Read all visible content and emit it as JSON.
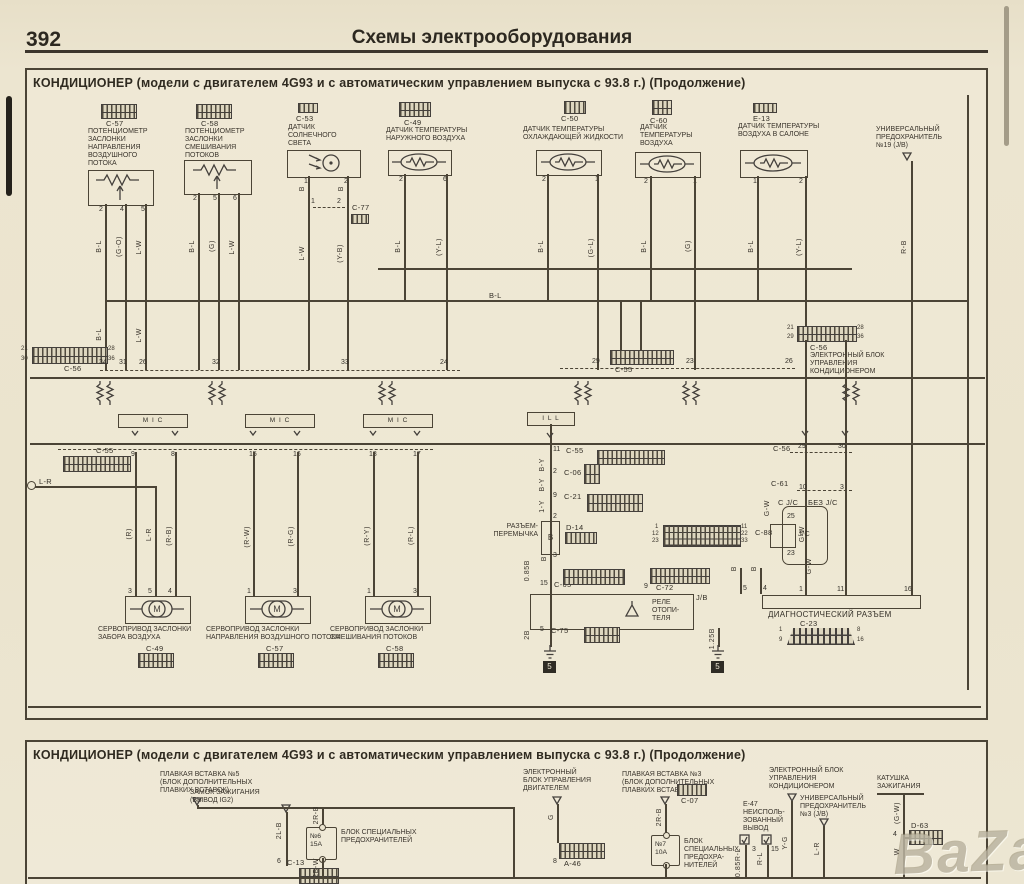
{
  "page": {
    "number": "392",
    "header": "Схемы электрооборудования"
  },
  "watermark": "BaZar",
  "panel1": {
    "title": "КОНДИЦИОНЕР (модели с двигателем 4G93 и с автоматическим управлением выпуска с 93.8 г.) (Продолжение)",
    "components": [
      {
        "id": "C-57",
        "name": "ПОТЕНЦИОМЕТР\nЗАСЛОНКИ\nНАПРАВЛЕНИЯ\nВОЗДУШНОГО\nПОТОКА",
        "pins": [
          "2",
          "4",
          "5"
        ]
      },
      {
        "id": "C-58",
        "name": "ПОТЕНЦИОМЕТР\nЗАСЛОНКИ\nСМЕШИВАНИЯ\nПОТОКОВ",
        "pins": [
          "2",
          "5",
          "6"
        ]
      },
      {
        "id": "C-53",
        "name": "ДАТЧИК\nСОЛНЕЧНОГО\nСВЕТА",
        "pins": [
          "1",
          "2"
        ]
      },
      {
        "id": "C-49",
        "name": "ДАТЧИК ТЕМПЕРАТУРЫ\nНАРУЖНОГО ВОЗДУХА",
        "pins": [
          "2",
          "6"
        ]
      },
      {
        "id": "C-50",
        "name": "ДАТЧИК ТЕМПЕРАТУРЫ\nОХЛАЖДАЮЩЕЙ ЖИДКОСТИ",
        "pins": [
          "2",
          "1"
        ]
      },
      {
        "id": "C-60",
        "name": "ДАТЧИК\nТЕМПЕРАТУРЫ\nВОЗДУХА",
        "pins": [
          "2",
          "1"
        ]
      },
      {
        "id": "E-13",
        "name": "ДАТЧИК ТЕМПЕРАТУРЫ\nВОЗДУХА В САЛОНЕ",
        "pins": [
          "1",
          "2"
        ]
      }
    ],
    "c77": {
      "id": "C-77",
      "pins": [
        "1",
        "2"
      ]
    },
    "fuse19": "УНИВЕРСАЛЬНЫЙ\nПРЕДОХРАНИТЕЛЬ\n№19 (J/B)",
    "bus_label": "B-L",
    "wire_labels": [
      "B-L",
      "(G-O)",
      "L-W",
      "B-L",
      "(G)",
      "L-W",
      "B",
      "B",
      "L-W",
      "(Y-B)",
      "B-L",
      "(Y-L)",
      "B-L",
      "(G-L)",
      "B-L",
      "(G)",
      "B-L",
      "(Y-L)",
      "R-B",
      "B-L",
      "L-W",
      "B-Y",
      "B-Y",
      "1-Y",
      "B",
      "0.85B",
      "2B",
      "1.25B",
      "B",
      "B",
      "G-W",
      "G-W",
      "G-W",
      "(R)",
      "L-R",
      "(R-B)",
      "(R-W)",
      "(R-G)",
      "(R-Y)",
      "(R-L)"
    ],
    "strips": {
      "c56_left": {
        "id": "C-56",
        "corners": [
          "21",
          "28",
          "30",
          "36"
        ]
      },
      "row_pins": [
        "34",
        "31",
        "26",
        "32",
        "33",
        "24"
      ],
      "c55_top": {
        "id": "C-55",
        "left_pin": "29",
        "right_pin": "23",
        "far_pin": "26"
      },
      "c56_right": {
        "id": "C-56",
        "desc": "ЭЛЕКТРОННЫЙ БЛОК\nУПРАВЛЕНИЯ\nКОНДИЦИОНЕРОМ",
        "corners": [
          "21",
          "28",
          "29",
          "36"
        ]
      },
      "c55_mid": {
        "id": "C-55",
        "pins": [
          "9",
          "8",
          "15",
          "16",
          "18",
          "17"
        ]
      },
      "lr": "L-R"
    },
    "blocks": {
      "mic": "M I C",
      "ill": "I L L"
    },
    "mid": {
      "c55_pin": "11",
      "c55_id": "C-55",
      "c06_pin": "2",
      "c06_id": "C-06",
      "c21_pin": "9",
      "c21_id": "C-21",
      "jump_pin_top": "2",
      "jumper": "РАЗЪЕМ-\nПЕРЕМЫЧКА",
      "jumper_letter": "В",
      "d14_id": "D-14",
      "jump_pin_bot": "3",
      "c65_pin": "15",
      "c65_id": "C-65",
      "c72_pin": "9",
      "c72_id": "C-72",
      "jb": "J/B",
      "relay": "РЕЛЕ\nОТОПИ-\nТЕЛЯ",
      "c75_pin": "5",
      "c75_id": "C-75",
      "gnd1": "5",
      "gnd2": "5",
      "b_pin1": "5",
      "b_pin2": "4",
      "c88_id": "C-88",
      "c88_corners": [
        "1",
        "11",
        "12",
        "22",
        "23",
        "33"
      ]
    },
    "right": {
      "c56_id": "C-56",
      "c56_p1": "29",
      "c56_p2": "30",
      "c61_id": "C-61",
      "c61_p1": "10",
      "c61_p2": "3",
      "jc_with": "С J/C",
      "jc_without": "БЕЗ J/C",
      "jc_box": "J/C",
      "jc_top": "25",
      "jc_bot": "23",
      "diag_label": "ДИАГНОСТИЧЕСКИЙ РАЗЪЕМ",
      "diag_id": "С-23",
      "diag_pins": [
        "1",
        "11",
        "16"
      ],
      "diag_corners": [
        "1",
        "8",
        "9",
        "16"
      ]
    },
    "servos": [
      {
        "name": "СЕРВОПРИВОД ЗАСЛОНКИ\nЗАБОРА ВОЗДУХА",
        "id": "C-49",
        "pins": [
          "3",
          "5",
          "4"
        ]
      },
      {
        "name": "СЕРВОПРИВОД ЗАСЛОНКИ\nНАПРАВЛЕНИЯ ВОЗДУШНОГО ПОТОКА",
        "id": "C-57",
        "pins": [
          "1",
          "3"
        ]
      },
      {
        "name": "СЕРВОПРИВОД ЗАСЛОНКИ\nСМЕШИВАНИЯ ПОТОКОВ",
        "id": "C-58",
        "pins": [
          "1",
          "3"
        ]
      }
    ],
    "motor_letter": "M"
  },
  "panel2": {
    "title": "КОНДИЦИОНЕР (модели с двигателем 4G93 и с автоматическим управлением выпуска с 93.8 г.) (Продолжение)",
    "ignition": {
      "name": "ЗАМОК ЗАЖИГАНИЯ\n(ВЫВОД IG2)",
      "wire": "2L-B",
      "pin": "6",
      "conn": "C-13"
    },
    "link5": {
      "name": "ПЛАВКАЯ ВСТАВКА №5\n(БЛОК ДОПОЛНИТЕЛЬНЫХ\nПЛАВКИХ ВСТАВОК)",
      "wire_in": "2R-B",
      "wire_out": "2B-W"
    },
    "fuse6": {
      "num": "№6",
      "amp": "15A",
      "label": "БЛОК СПЕЦИАЛЬНЫХ\nПРЕДОХРАНИТЕЛЕЙ"
    },
    "ecu_engine": {
      "name": "ЭЛЕКТРОННЫЙ\nБЛОК УПРАВЛЕНИЯ\nДВИГАТЕЛЕМ",
      "wire": "G",
      "pin": "8",
      "conn": "A-46"
    },
    "link3": {
      "name": "ПЛАВКАЯ ВСТАВКА №3\n(БЛОК ДОПОЛНИТЕЛЬНЫХ\nПЛАВКИХ ВСТАВОК)",
      "wire": "2R-B"
    },
    "fuse7": {
      "num": "№7",
      "amp": "10A",
      "label": "БЛОК\nСПЕЦИАЛЬНЫХ\nПРЕДОХРА-\nНИТЕЛЕЙ"
    },
    "c07_id": "C-07",
    "e47": {
      "name": "E-47\nНЕИСПОЛЬ-\nЗОВАННЫЙ\nВЫВОД",
      "pin1": "3",
      "pin2": "15",
      "wire1": "0.85R-L",
      "wire2": "R-L"
    },
    "ecu_ac": {
      "name": "ЭЛЕКТРОННЫЙ БЛОК\nУПРАВЛЕНИЯ\nКОНДИЦИОНЕРОМ",
      "wire": "Y-G"
    },
    "fuse3": {
      "name": "УНИВЕРСАЛЬНЫЙ\nПРЕДОХРАНИТЕЛЬ\n№3 (J/B)",
      "wire": "L-R"
    },
    "coil": {
      "name": "КАТУШКА\nЗАЖИГАНИЯ",
      "wire_top": "(G-W)",
      "pin": "4",
      "conn": "D-63",
      "wire_bot": "W"
    }
  }
}
